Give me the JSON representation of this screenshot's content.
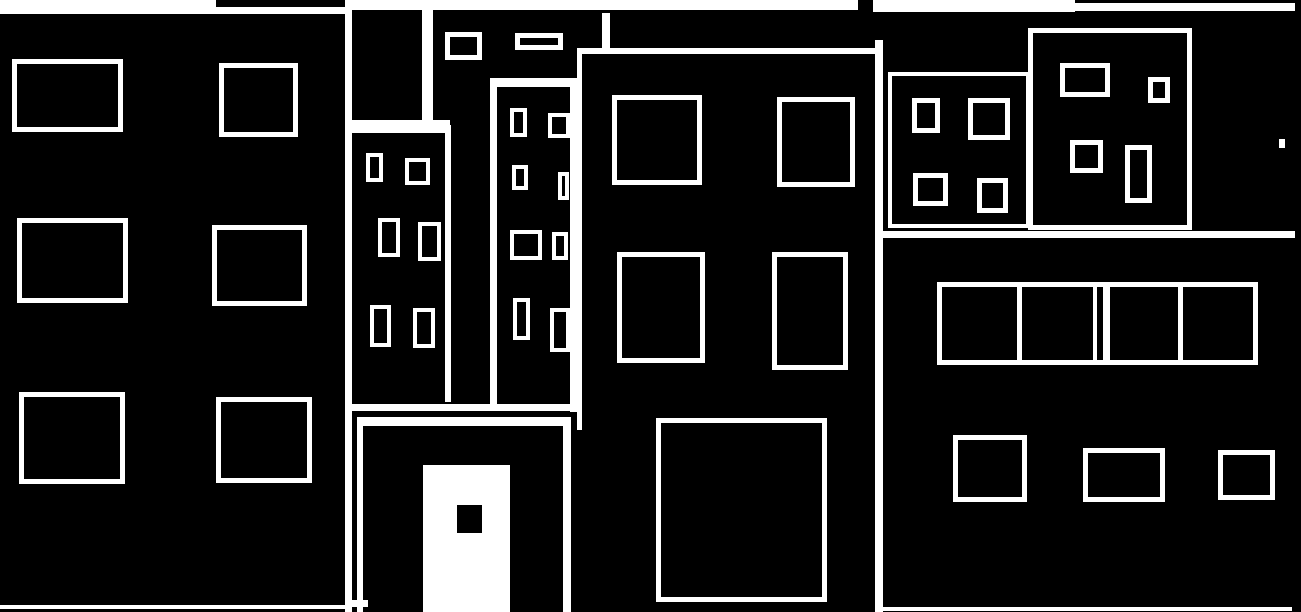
{
  "scene": {
    "description": "binarized-city-facade-illustration",
    "background_color": "#000000",
    "stroke_color": "#ffffff",
    "width": 1301,
    "height": 612
  },
  "shapes": [
    {
      "name": "top-band-left",
      "type": "fill",
      "x": 0,
      "y": 0,
      "w": 216,
      "h": 14
    },
    {
      "name": "top-band-left-thin",
      "type": "fill",
      "x": 216,
      "y": 7,
      "w": 129,
      "h": 7
    },
    {
      "name": "top-band-middle",
      "type": "fill",
      "x": 345,
      "y": 0,
      "w": 513,
      "h": 10
    },
    {
      "name": "top-band-right",
      "type": "fill",
      "x": 873,
      "y": 0,
      "w": 202,
      "h": 12
    },
    {
      "name": "top-band-right-thin",
      "type": "fill",
      "x": 1075,
      "y": 3,
      "w": 220,
      "h": 8
    },
    {
      "name": "left-facade-divider-line",
      "type": "fill",
      "x": 345,
      "y": 0,
      "w": 7,
      "h": 612
    },
    {
      "name": "left-building-baseline",
      "type": "fill",
      "x": 0,
      "y": 605,
      "w": 345,
      "h": 4
    },
    {
      "name": "left-window-r1c1",
      "type": "outline",
      "border": 5,
      "x": 12,
      "y": 59,
      "w": 111,
      "h": 73
    },
    {
      "name": "left-window-r1c2",
      "type": "outline",
      "border": 5,
      "x": 219,
      "y": 63,
      "w": 79,
      "h": 74
    },
    {
      "name": "left-window-r2c1",
      "type": "outline",
      "border": 5,
      "x": 17,
      "y": 218,
      "w": 111,
      "h": 85
    },
    {
      "name": "left-window-r2c2",
      "type": "outline",
      "border": 5,
      "x": 212,
      "y": 225,
      "w": 95,
      "h": 81
    },
    {
      "name": "left-window-r3c1",
      "type": "outline",
      "border": 5,
      "x": 19,
      "y": 392,
      "w": 106,
      "h": 92
    },
    {
      "name": "left-window-r3c2",
      "type": "outline",
      "border": 5,
      "x": 216,
      "y": 397,
      "w": 96,
      "h": 86
    },
    {
      "name": "tower1-roof-right-line",
      "type": "fill",
      "x": 422,
      "y": 8,
      "w": 11,
      "h": 112
    },
    {
      "name": "tower1-gap-band",
      "type": "fill",
      "x": 352,
      "y": 120,
      "w": 98,
      "h": 13
    },
    {
      "name": "tower1-lower-right-line",
      "type": "fill",
      "x": 445,
      "y": 125,
      "w": 6,
      "h": 277
    },
    {
      "name": "tower1-window-1",
      "type": "outline",
      "border": 4,
      "x": 366,
      "y": 153,
      "w": 17,
      "h": 29
    },
    {
      "name": "tower1-window-2",
      "type": "outline",
      "border": 4,
      "x": 405,
      "y": 158,
      "w": 25,
      "h": 27
    },
    {
      "name": "tower1-window-3",
      "type": "outline",
      "border": 4,
      "x": 378,
      "y": 218,
      "w": 22,
      "h": 39
    },
    {
      "name": "tower1-window-4",
      "type": "outline",
      "border": 4,
      "x": 418,
      "y": 222,
      "w": 23,
      "h": 39
    },
    {
      "name": "tower1-window-5",
      "type": "outline",
      "border": 4,
      "x": 370,
      "y": 305,
      "w": 21,
      "h": 42
    },
    {
      "name": "tower1-window-6",
      "type": "outline",
      "border": 4,
      "x": 413,
      "y": 308,
      "w": 22,
      "h": 40
    },
    {
      "name": "floating-window-small",
      "type": "outline",
      "border": 5,
      "x": 445,
      "y": 32,
      "w": 37,
      "h": 28
    },
    {
      "name": "floating-window-wide",
      "type": "outline",
      "border": 5,
      "x": 515,
      "y": 33,
      "w": 48,
      "h": 17
    },
    {
      "name": "tower2-top-border",
      "type": "fill",
      "x": 490,
      "y": 78,
      "w": 87,
      "h": 9
    },
    {
      "name": "tower2-left-border",
      "type": "fill",
      "x": 490,
      "y": 87,
      "w": 7,
      "h": 320
    },
    {
      "name": "tower2-right-border",
      "type": "fill",
      "x": 570,
      "y": 87,
      "w": 7,
      "h": 325
    },
    {
      "name": "tower2-window-1",
      "type": "outline",
      "border": 4,
      "x": 510,
      "y": 108,
      "w": 17,
      "h": 29
    },
    {
      "name": "tower2-window-2",
      "type": "outline",
      "border": 4,
      "x": 548,
      "y": 113,
      "w": 22,
      "h": 25
    },
    {
      "name": "tower2-window-3",
      "type": "outline",
      "border": 4,
      "x": 512,
      "y": 165,
      "w": 16,
      "h": 25
    },
    {
      "name": "tower2-window-4",
      "type": "outline",
      "border": 4,
      "x": 558,
      "y": 172,
      "w": 11,
      "h": 28
    },
    {
      "name": "tower2-window-5",
      "type": "outline",
      "border": 4,
      "x": 510,
      "y": 230,
      "w": 32,
      "h": 30
    },
    {
      "name": "tower2-window-6",
      "type": "outline",
      "border": 4,
      "x": 552,
      "y": 232,
      "w": 16,
      "h": 28
    },
    {
      "name": "tower2-window-7",
      "type": "outline",
      "border": 4,
      "x": 513,
      "y": 298,
      "w": 17,
      "h": 42
    },
    {
      "name": "tower2-window-8",
      "type": "outline",
      "border": 4,
      "x": 550,
      "y": 308,
      "w": 20,
      "h": 44
    },
    {
      "name": "door-lintel-line",
      "type": "fill",
      "x": 345,
      "y": 404,
      "w": 235,
      "h": 7
    },
    {
      "name": "door-frame-top",
      "type": "fill",
      "x": 357,
      "y": 417,
      "w": 214,
      "h": 9
    },
    {
      "name": "door-frame-left",
      "type": "fill",
      "x": 357,
      "y": 417,
      "w": 6,
      "h": 195
    },
    {
      "name": "door-frame-right",
      "type": "fill",
      "x": 563,
      "y": 417,
      "w": 8,
      "h": 195
    },
    {
      "name": "door-corner-mark",
      "type": "fill",
      "x": 352,
      "y": 600,
      "w": 16,
      "h": 7
    },
    {
      "name": "door-panel",
      "type": "fill",
      "x": 423,
      "y": 465,
      "w": 87,
      "h": 147
    },
    {
      "name": "door-handle",
      "type": "fill",
      "color": "black",
      "x": 457,
      "y": 505,
      "w": 25,
      "h": 28
    },
    {
      "name": "center-top-border",
      "type": "fill",
      "x": 577,
      "y": 48,
      "w": 306,
      "h": 6
    },
    {
      "name": "center-left-border",
      "type": "fill",
      "x": 577,
      "y": 54,
      "w": 5,
      "h": 376
    },
    {
      "name": "center-right-border",
      "type": "fill",
      "x": 875,
      "y": 40,
      "w": 8,
      "h": 572
    },
    {
      "name": "center-roof-tick",
      "type": "fill",
      "x": 602,
      "y": 13,
      "w": 8,
      "h": 35
    },
    {
      "name": "center-window-r1c1",
      "type": "outline",
      "border": 5,
      "x": 612,
      "y": 95,
      "w": 90,
      "h": 90
    },
    {
      "name": "center-window-r1c2",
      "type": "outline",
      "border": 5,
      "x": 777,
      "y": 97,
      "w": 78,
      "h": 90
    },
    {
      "name": "center-window-r2c1",
      "type": "outline",
      "border": 5,
      "x": 617,
      "y": 252,
      "w": 88,
      "h": 111
    },
    {
      "name": "center-window-r2c2",
      "type": "outline",
      "border": 5,
      "x": 772,
      "y": 252,
      "w": 76,
      "h": 118
    },
    {
      "name": "center-big-window",
      "type": "outline",
      "border": 5,
      "x": 656,
      "y": 418,
      "w": 171,
      "h": 184
    },
    {
      "name": "right-building-a-frame",
      "type": "outline",
      "border": 4,
      "x": 888,
      "y": 72,
      "w": 142,
      "h": 156
    },
    {
      "name": "bldg-a-window-1",
      "type": "outline",
      "border": 5,
      "x": 912,
      "y": 98,
      "w": 28,
      "h": 35
    },
    {
      "name": "bldg-a-window-2",
      "type": "outline",
      "border": 5,
      "x": 968,
      "y": 98,
      "w": 42,
      "h": 42
    },
    {
      "name": "bldg-a-window-3",
      "type": "outline",
      "border": 5,
      "x": 913,
      "y": 173,
      "w": 35,
      "h": 33
    },
    {
      "name": "bldg-a-window-4",
      "type": "outline",
      "border": 5,
      "x": 977,
      "y": 178,
      "w": 31,
      "h": 35
    },
    {
      "name": "right-building-b-frame",
      "type": "outline",
      "border": 5,
      "x": 1028,
      "y": 28,
      "w": 164,
      "h": 202
    },
    {
      "name": "bldg-b-window-1",
      "type": "outline",
      "border": 5,
      "x": 1060,
      "y": 63,
      "w": 50,
      "h": 34
    },
    {
      "name": "bldg-b-window-2",
      "type": "outline",
      "border": 5,
      "x": 1148,
      "y": 77,
      "w": 22,
      "h": 26
    },
    {
      "name": "bldg-b-window-3",
      "type": "outline",
      "border": 5,
      "x": 1070,
      "y": 140,
      "w": 33,
      "h": 33
    },
    {
      "name": "bldg-b-window-4",
      "type": "outline",
      "border": 5,
      "x": 1125,
      "y": 145,
      "w": 27,
      "h": 58
    },
    {
      "name": "right-ledge-band",
      "type": "fill",
      "x": 883,
      "y": 231,
      "w": 412,
      "h": 7
    },
    {
      "name": "window-strip-frame",
      "type": "outline",
      "border": 5,
      "x": 937,
      "y": 282,
      "w": 321,
      "h": 83
    },
    {
      "name": "strip-divider-1",
      "type": "fill",
      "x": 1017,
      "y": 287,
      "w": 5,
      "h": 73
    },
    {
      "name": "strip-divider-2a",
      "type": "fill",
      "x": 1093,
      "y": 287,
      "w": 4,
      "h": 73
    },
    {
      "name": "strip-divider-2b",
      "type": "fill",
      "x": 1103,
      "y": 287,
      "w": 7,
      "h": 73
    },
    {
      "name": "strip-divider-3",
      "type": "fill",
      "x": 1178,
      "y": 287,
      "w": 5,
      "h": 73
    },
    {
      "name": "right-window-low-1",
      "type": "outline",
      "border": 5,
      "x": 953,
      "y": 435,
      "w": 74,
      "h": 67
    },
    {
      "name": "right-window-low-2",
      "type": "outline",
      "border": 5,
      "x": 1083,
      "y": 448,
      "w": 82,
      "h": 54
    },
    {
      "name": "right-window-low-3",
      "type": "outline",
      "border": 5,
      "x": 1218,
      "y": 450,
      "w": 57,
      "h": 50
    },
    {
      "name": "right-baseline",
      "type": "fill",
      "x": 883,
      "y": 607,
      "w": 409,
      "h": 4
    },
    {
      "name": "right-edge-mark",
      "type": "fill",
      "x": 1279,
      "y": 139,
      "w": 6,
      "h": 9
    }
  ]
}
